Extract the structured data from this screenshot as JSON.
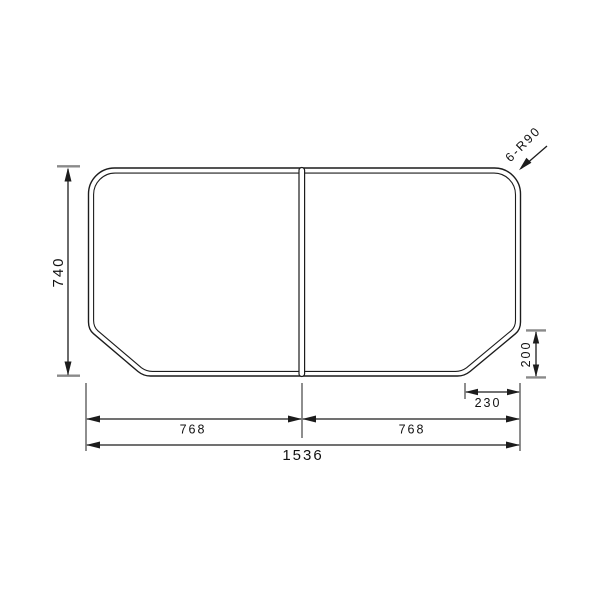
{
  "drawing": {
    "title": "two-panel folding bath lid dimension drawing (top view)",
    "labels": {
      "height": "740",
      "left_panel_width": "768",
      "right_panel_width": "768",
      "total_width": "1536",
      "chamfer_width": "230",
      "chamfer_height": "200",
      "corner_radius": "6-R90"
    },
    "colors": {
      "line": "#1c1c1c",
      "extension_tick": "#8a8a8a",
      "background": "#ffffff",
      "text": "#111111"
    }
  }
}
